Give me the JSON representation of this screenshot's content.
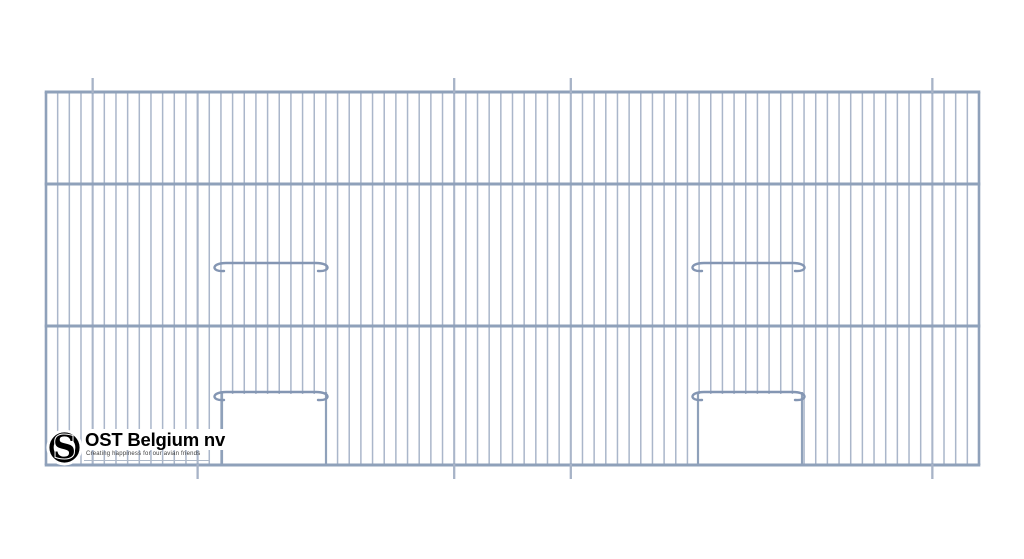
{
  "page": {
    "background": "#ffffff",
    "description": "Technical line drawing of a wire cage front panel"
  },
  "logo": {
    "emblem_icon": "ost-circle-s-monogram",
    "emblem_letter": "S",
    "company": "OST Belgium nv",
    "tagline": "Creating happiness for our avian friends",
    "text_color": "#000000",
    "tagline_color": "#3d3d3d"
  },
  "drawing": {
    "type": "cage-front-wire-panel",
    "wire_color": "#aab6ca",
    "frame_color": "#8fa1ba",
    "bar_color": "#8496b3",
    "tick_color": "#a7b3c7",
    "frame": {
      "x1": 46,
      "x2": 979,
      "y1": 92,
      "y2": 465
    },
    "rails_y": [
      92,
      184,
      326,
      465
    ],
    "wire_count": 81,
    "wire_width": 1.5,
    "seam_wire_width": 2.1,
    "edge_wire_width": 2.6,
    "rail_width": 3,
    "bar_width": 2.4,
    "seam_x": [
      93,
      197,
      453,
      569,
      930
    ],
    "ticks": {
      "top_x": [
        93,
        453,
        569,
        930
      ],
      "bottom_x": [
        197,
        453,
        569,
        930
      ],
      "length": 14,
      "width": 2.3
    },
    "perch_bars": [
      {
        "x1": 213,
        "x2": 329,
        "y": 263
      },
      {
        "x1": 691,
        "x2": 806,
        "y": 263
      }
    ],
    "door_bars": [
      {
        "x1": 213,
        "x2": 329,
        "y": 392
      },
      {
        "x1": 691,
        "x2": 806,
        "y": 392
      }
    ],
    "door_openings": [
      {
        "x1": 222,
        "x2": 326,
        "y1": 394,
        "y2": 465
      },
      {
        "x1": 698,
        "x2": 802,
        "y1": 394,
        "y2": 465
      }
    ]
  }
}
